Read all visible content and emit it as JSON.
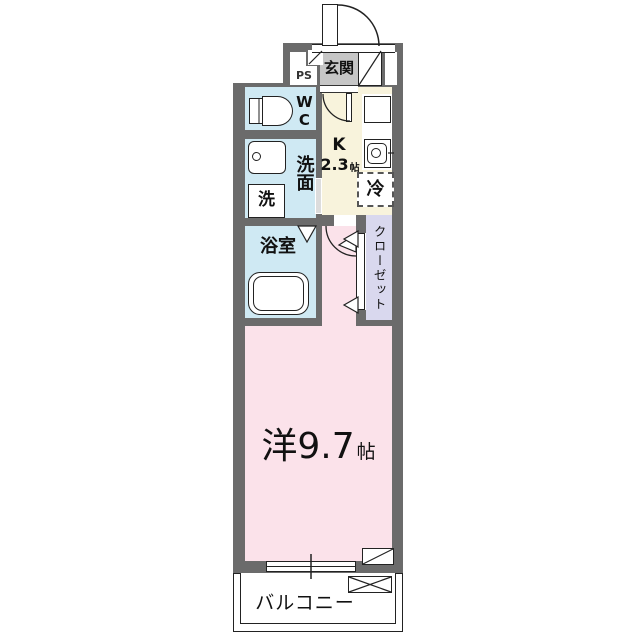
{
  "plan": {
    "colors": {
      "wall": "#6b6b6b",
      "wet": "#cfe9f3",
      "kitchen": "#f8f3dc",
      "room": "#fbe2ea",
      "closet": "#d9d8ee",
      "genkan": "#c6c6c6"
    },
    "labels": {
      "entrance": "玄関",
      "pipe_space": "PS",
      "toilet": "WC",
      "washroom": "洗面",
      "washer": "洗",
      "bathroom": "浴室",
      "kitchen_type": "K",
      "kitchen_size": "2.3",
      "kitchen_unit": "帖",
      "fridge": "冷",
      "closet": "クローゼット",
      "room_size": "洋9.7",
      "room_unit": "帖",
      "balcony": "バルコニー"
    }
  }
}
